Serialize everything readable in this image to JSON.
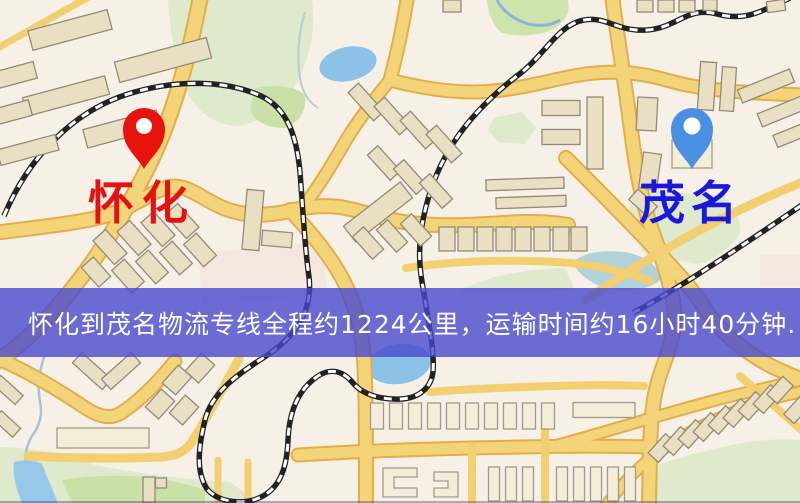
{
  "map": {
    "origin_marker": {
      "label": "怀化",
      "pin_color": "#e8130c",
      "pin_dot_color": "#ffffff",
      "label_color": "#e41310"
    },
    "destination_marker": {
      "label": "茂名",
      "pin_color": "#4a90e2",
      "pin_dot_color": "#ffffff",
      "label_color": "#1a18dd"
    },
    "palette": {
      "road_fill": "#f4d478",
      "road_edge": "#e2ae4c",
      "railway": "#222222",
      "park": "#dfe9cb",
      "water": "#8cc2e6",
      "building": "#e9dfc2",
      "background": "#f7f0e7"
    }
  },
  "banner": {
    "text": "怀化到茂名物流专线全程约1224公里，运输时间约16小时40分钟.",
    "background_color": "rgba(73,73,206,0.8)",
    "text_color": "#ffffff"
  }
}
